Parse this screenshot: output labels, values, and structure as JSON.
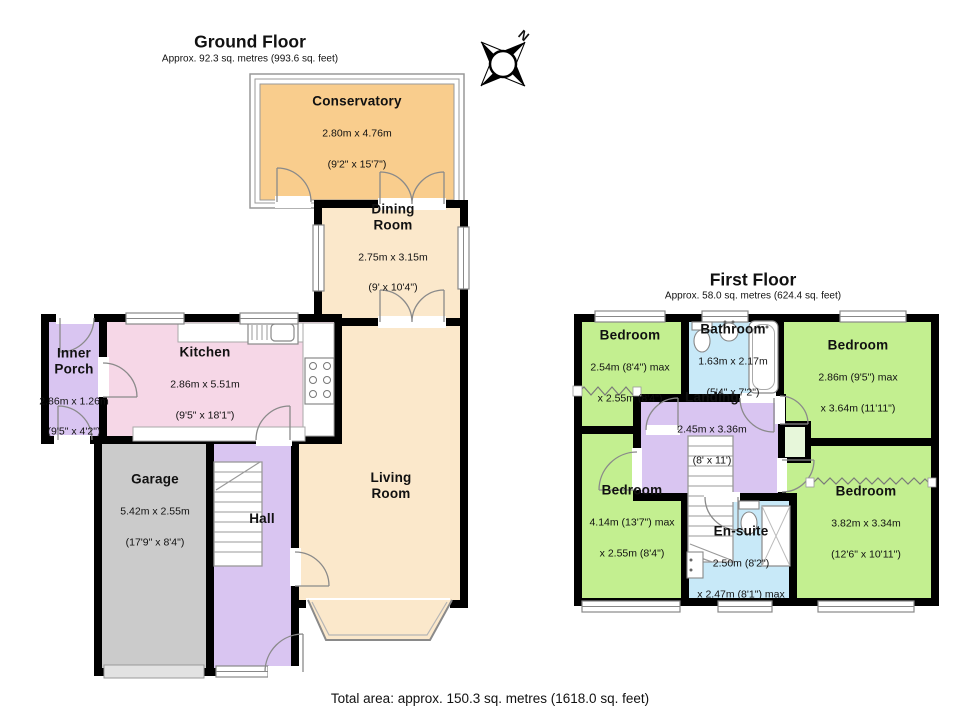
{
  "colors": {
    "wall": "#000000",
    "conservatory_orange": "#F9CD8D",
    "cream": "#FBE8CB",
    "kitchen_pink": "#F6D7E7",
    "hall_purple": "#D9C5F1",
    "garage_grey": "#CBCBCB",
    "bedroom_green": "#C3EF90",
    "bath_blue": "#C8E9F8",
    "closet_pale_green": "#E7F7DA"
  },
  "compass": {
    "north_label": "N"
  },
  "ground_floor": {
    "title": "Ground Floor",
    "subtitle": "Approx. 92.3 sq. metres (993.6 sq. feet)",
    "rooms": {
      "conservatory": {
        "name": "Conservatory",
        "dim_line1": "2.80m x 4.76m",
        "dim_line2": "(9'2\" x 15'7\")"
      },
      "dining_room": {
        "name": "Dining\nRoom",
        "dim_line1": "2.75m x 3.15m",
        "dim_line2": "(9' x 10'4\")"
      },
      "kitchen": {
        "name": "Kitchen",
        "dim_line1": "2.86m x 5.51m",
        "dim_line2": "(9'5\" x 18'1\")"
      },
      "inner_porch": {
        "name": "Inner\nPorch",
        "dim_line1": "2.86m x 1.26m",
        "dim_line2": "(9'5\" x 4'2\")"
      },
      "garage": {
        "name": "Garage",
        "dim_line1": "5.42m x 2.55m",
        "dim_line2": "(17'9\" x 8'4\")"
      },
      "hall": {
        "name": "Hall"
      },
      "living_room": {
        "name": "Living\nRoom"
      }
    }
  },
  "first_floor": {
    "title": "First Floor",
    "subtitle": "Approx. 58.0 sq. metres (624.4 sq. feet)",
    "rooms": {
      "bedroom_top_left": {
        "name": "Bedroom",
        "dim_line1": "2.54m (8'4\") max",
        "dim_line2": "x 2.55m (8'4\")"
      },
      "bathroom": {
        "name": "Bathroom",
        "dim_line1": "1.63m x 2.17m",
        "dim_line2": "(5'4\" x 7'2\")"
      },
      "bedroom_top_right": {
        "name": "Bedroom",
        "dim_line1": "2.86m (9'5\") max",
        "dim_line2": "x 3.64m (11'11\")"
      },
      "landing": {
        "name": "Landing",
        "dim_line1": "2.45m x 3.36m",
        "dim_line2": "(8' x 11')"
      },
      "bedroom_bottom_left": {
        "name": "Bedroom",
        "dim_line1": "4.14m (13'7\") max",
        "dim_line2": "x 2.55m (8'4\")"
      },
      "en_suite": {
        "name": "En-suite",
        "dim_line1": "2.50m (8'2\")",
        "dim_line2": "x 2.47m (8'1\") max"
      },
      "bedroom_bottom_right": {
        "name": "Bedroom",
        "dim_line1": "3.82m x 3.34m",
        "dim_line2": "(12'6\" x 10'11\")"
      }
    }
  },
  "footer": {
    "total_area": "Total area: approx. 150.3 sq. metres (1618.0 sq. feet)"
  }
}
